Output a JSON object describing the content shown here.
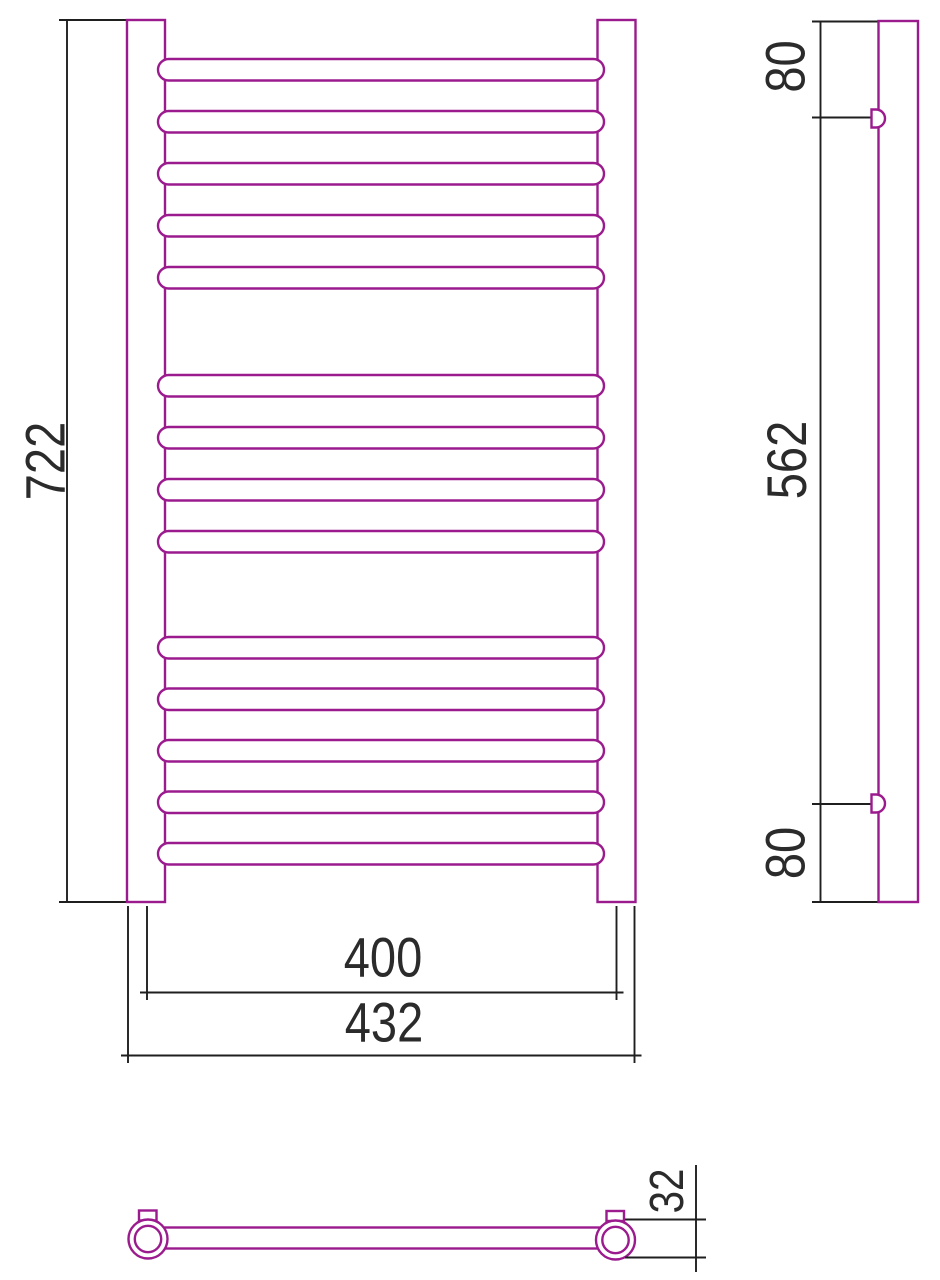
{
  "colors": {
    "product_outline": "#9b1b8e",
    "dimension_lines": "#1f1f1f",
    "dimension_text": "#2b2b2b",
    "background": "#ffffff"
  },
  "front_view": {
    "height_label": "722",
    "rail_center_width_label": "400",
    "overall_width_label": "432"
  },
  "side_view": {
    "top_bracket_offset_label": "80",
    "bracket_spacing_label": "562",
    "bottom_bracket_offset_label": "80"
  },
  "top_view": {
    "depth_label": "32"
  }
}
